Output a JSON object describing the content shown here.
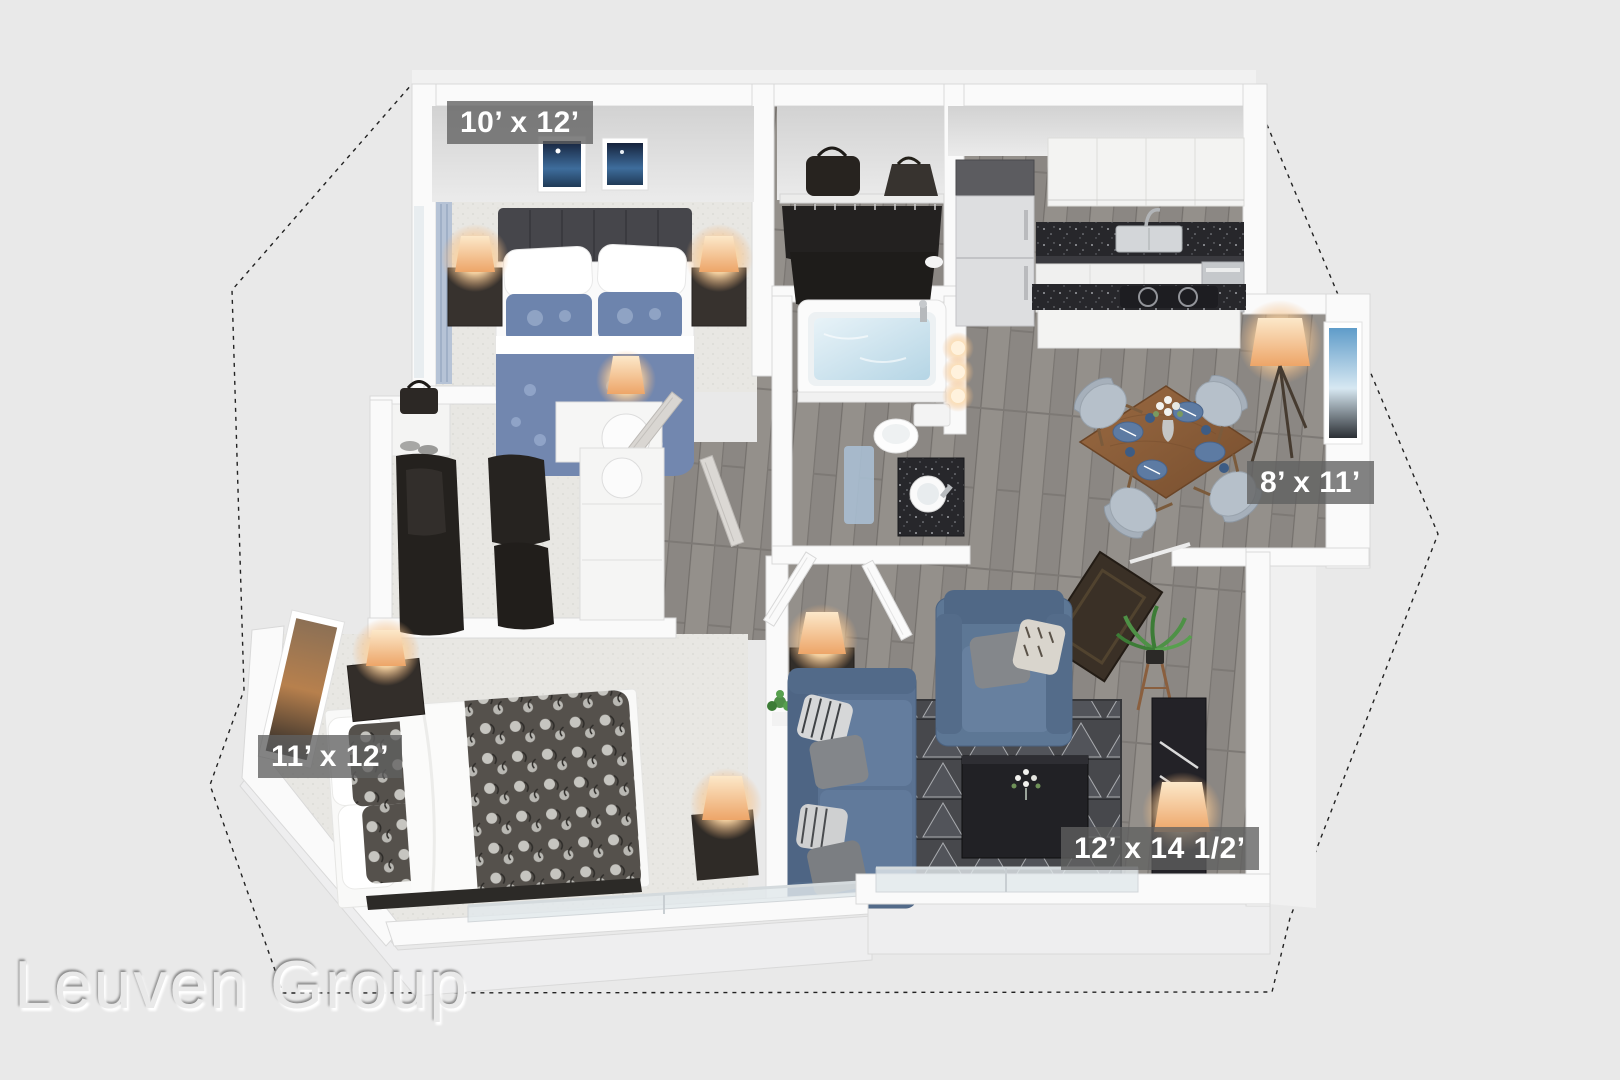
{
  "page": {
    "type": "3d-apartment-floor-plan-rendering",
    "background": "#e9e9e9"
  },
  "watermark": {
    "text": "Leuven Group"
  },
  "room_labels": [
    {
      "room": "bedroom-top-left",
      "text": "10’ x 12’"
    },
    {
      "room": "dining-nook",
      "text": "8’ x 11’"
    },
    {
      "room": "bedroom-bottom-left",
      "text": "11’ x 12’"
    },
    {
      "room": "living-room",
      "text": "12’ x 14 1/2’"
    }
  ],
  "palette": {
    "background": "#e9e9e9",
    "walls": "#fafafa",
    "carpet": "#e8e7e3",
    "wood_floor": "#918c88",
    "rug_dark": "#47484c",
    "bedding_blue": "#7287af",
    "sofa_blue": "#5a7292",
    "dark_furniture": "#2e2a27",
    "counter_granite": "#27272b",
    "table_wood": "#8a5f3d",
    "lamp_glow": "#f6c186",
    "water_blue": "#bcd8e6",
    "label_background": "rgba(96,96,96,0.78)",
    "label_text": "#ffffff"
  }
}
